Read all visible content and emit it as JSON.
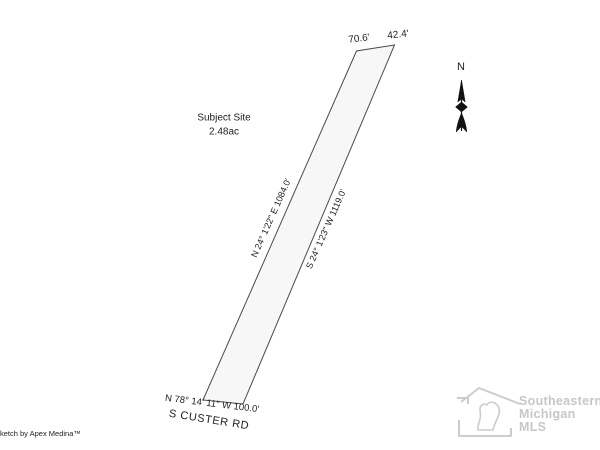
{
  "sketch": {
    "subject_site_label": "Subject Site",
    "area_label": "2.48ac",
    "top_left_dim": "70.6'",
    "top_right_dim": "42.4'",
    "west_boundary": "N 24° 1'22\" E  1084.0'",
    "east_boundary": "S 24° 1'23\" W  1119.0'",
    "south_boundary": "N 78° 14' 11\" W  100.0'",
    "road_label": "S CUSTER RD"
  },
  "compass": {
    "north_label": "N"
  },
  "credits": {
    "sketch_by": "Sketch by Apex Medina™"
  },
  "watermark": {
    "line1": "Southeastern",
    "line2": "Michigan",
    "line3": "MLS"
  },
  "colors": {
    "parcel_outline": "#4a4a4a",
    "parcel_fill": "#f7f7f7",
    "text": "#1f1f1f",
    "watermark_gray": "#c8c8c8",
    "compass_black": "#111111"
  }
}
